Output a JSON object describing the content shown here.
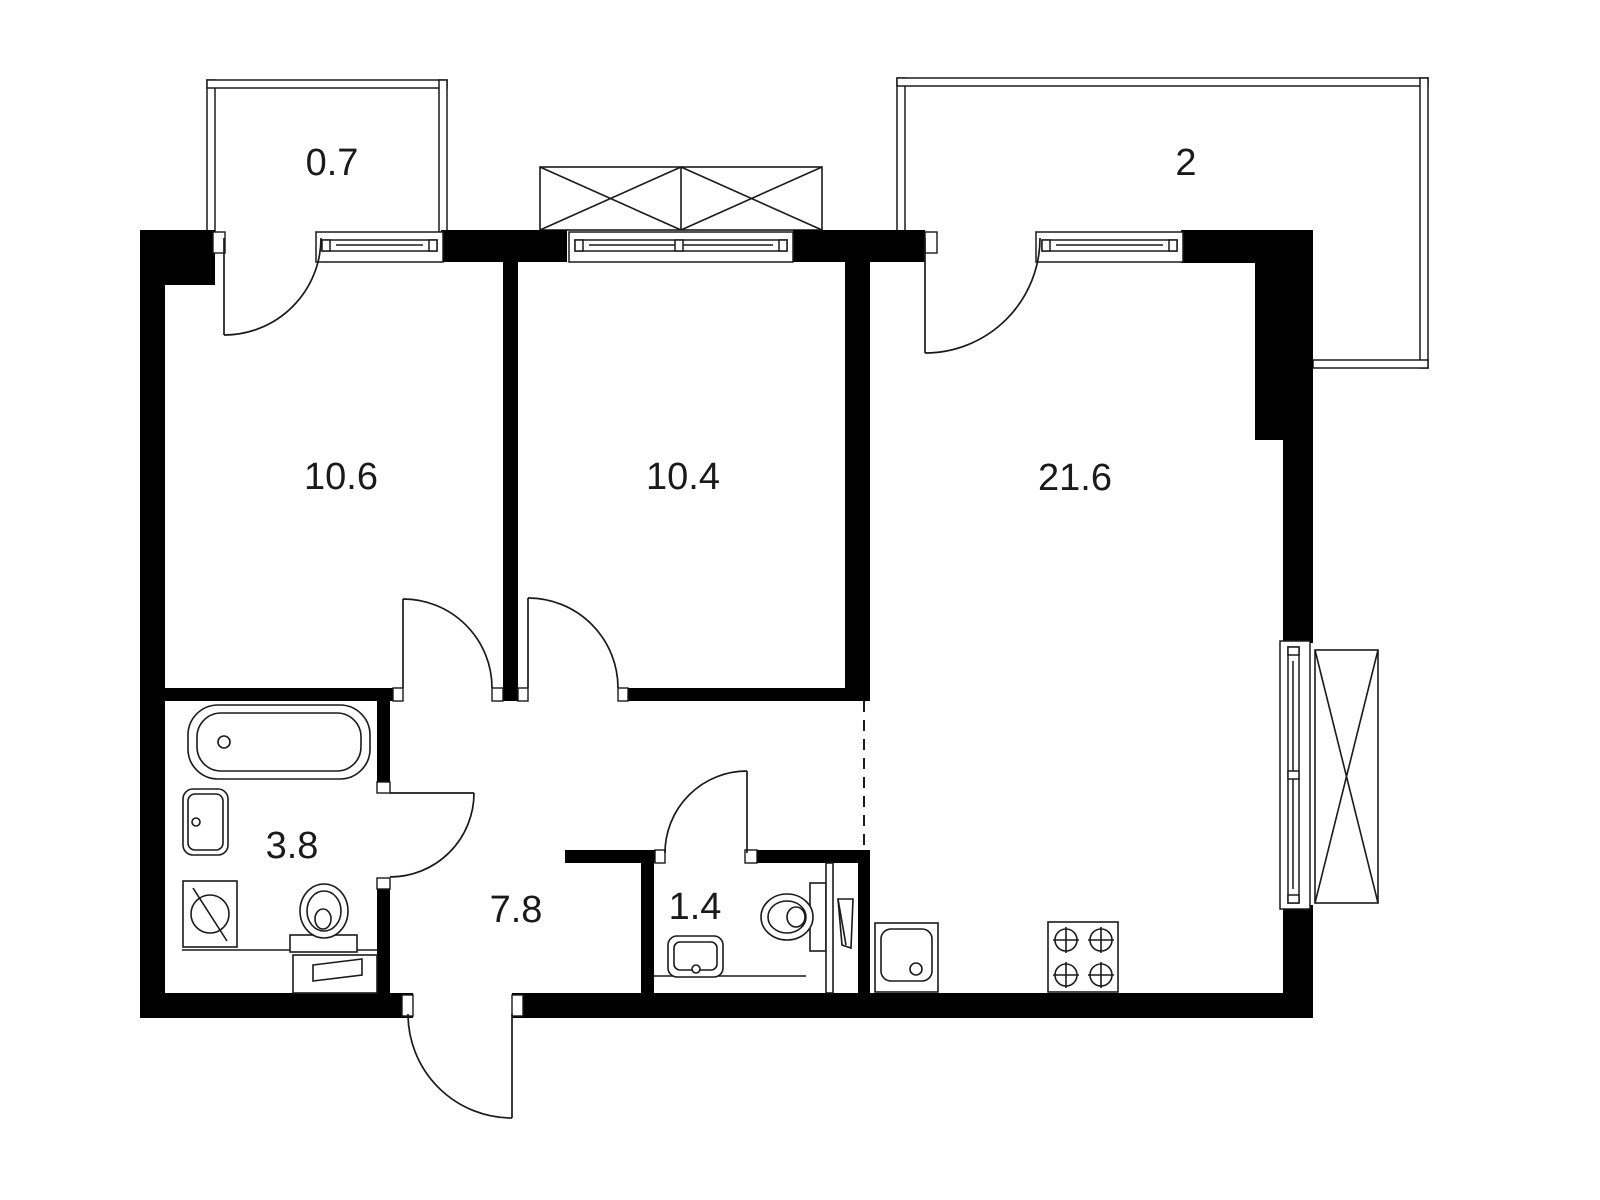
{
  "plan": {
    "type": "apartment-floor-plan",
    "background": "#ffffff",
    "wall_color": "#000000",
    "line_color": "#1a1a1a",
    "rooms": [
      {
        "id": "balcony-small",
        "label": "0.7"
      },
      {
        "id": "balcony-large",
        "label": "2"
      },
      {
        "id": "room-left",
        "label": "10.6"
      },
      {
        "id": "room-middle",
        "label": "10.4"
      },
      {
        "id": "living-kitchen",
        "label": "21.6"
      },
      {
        "id": "bathroom",
        "label": "3.8"
      },
      {
        "id": "hallway",
        "label": "7.8"
      },
      {
        "id": "wc",
        "label": "1.4"
      }
    ],
    "fixtures": [
      "bathtub",
      "bathroom-sink",
      "washing-machine",
      "bathroom-toilet",
      "bathroom-cabinet",
      "wc-sink",
      "wc-toilet",
      "water-heater",
      "kitchen-sink",
      "stove-4-burner"
    ],
    "symbols": [
      "window",
      "door-swing",
      "ac-basket",
      "dashed-zone-boundary"
    ]
  }
}
